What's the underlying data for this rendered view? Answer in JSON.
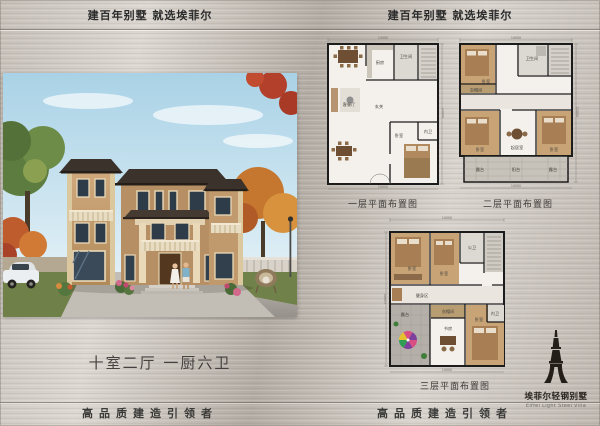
{
  "header": {
    "left": "建百年别墅  就选埃菲尔",
    "right": "建百年别墅  就选埃菲尔"
  },
  "hero": {
    "caption": "十室二厅 一厨六卫",
    "subject": "three-story-tan-villa-autumn-scene"
  },
  "plans": {
    "floor1": {
      "label": "一层平面布置图",
      "dims": {
        "width": "10000",
        "height": "15000"
      },
      "rooms": [
        "厨房",
        "卫生间",
        "客餐厅",
        "玄关",
        "卧室",
        "内卫"
      ]
    },
    "floor2": {
      "label": "二层平面布置图",
      "dims": {
        "width": "10000",
        "height": "15000"
      },
      "rooms": [
        "卧室",
        "衣帽间",
        "卫生间",
        "卧室",
        "起居室",
        "卧室",
        "露台",
        "阳台",
        "露台"
      ]
    },
    "floor3": {
      "label": "三层平面布置图",
      "dims": {
        "width": "10000",
        "height": "15000"
      },
      "rooms": [
        "卧室",
        "卧室",
        "公卫",
        "健身区",
        "露台",
        "衣帽间",
        "书房",
        "卧室",
        "内卫"
      ]
    }
  },
  "footer": {
    "left": "高品质建造引领者",
    "right": "高品质建造引领者"
  },
  "brand": {
    "name": "埃菲尔轻钢别墅",
    "name_en": "Eiffel Light Steel Villa",
    "icon": "eiffel-tower-icon"
  },
  "colors": {
    "plate": "#c6c0b9",
    "ink": "#2b2b2b",
    "wall_tan": "#c7a377",
    "roof_dark": "#3a322b",
    "plan_wood": "#c8a375",
    "plan_floor": "#f4f1ec"
  }
}
